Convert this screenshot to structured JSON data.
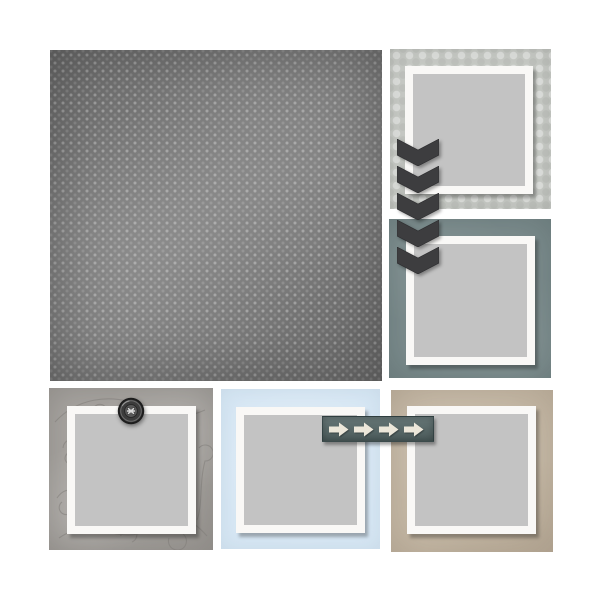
{
  "page": {
    "name": "Digital scrapbook quick-page layout with five photo frames",
    "background": "#ffffff"
  },
  "palette": {
    "page_bg": "#ffffff",
    "dot_paper": "#7e7e7e",
    "sage_paper": "#c7cac5",
    "slate_paper": "#7e8e8f",
    "swirl_paper": "#a8a5a1",
    "swirl_line": "#807d79",
    "blue_paper": "#d7e7f4",
    "tan_paper": "#c8bca9",
    "frame_white": "#f9f8f6",
    "photo_gray": "#c3c3c3",
    "chevron": "#3d3d3f",
    "ribbon": "#566868",
    "ribbon_arrow": "#ece7da",
    "button_dark": "#2a2a2a"
  },
  "papers": [
    {
      "label": "Charcoal pin-dot paper",
      "pattern": "light dot grid on mottled charcoal",
      "color": "#7e7e7e"
    },
    {
      "label": "Sage gray circle paper",
      "pattern": "tone-on-tone polka circles",
      "color": "#c7cac5"
    },
    {
      "label": "Slate blue-gray paper",
      "pattern": "subtle mottled texture",
      "color": "#7e8e8f"
    },
    {
      "label": "Gray doodle swirl paper",
      "pattern": "thin doodled loops and swirls",
      "color": "#a8a5a1"
    },
    {
      "label": "Powder blue paper",
      "pattern": "solid",
      "color": "#d7e7f4"
    },
    {
      "label": "Tan kraft paper",
      "pattern": "solid mottled",
      "color": "#c8bca9"
    }
  ],
  "photo_slots": [
    {
      "label": "Photo slot 1 - top right"
    },
    {
      "label": "Photo slot 2 - middle right"
    },
    {
      "label": "Photo slot 3 - bottom left"
    },
    {
      "label": "Photo slot 4 - bottom center"
    },
    {
      "label": "Photo slot 5 - bottom right"
    }
  ],
  "embellishments": {
    "chevron_stack": {
      "label": "Stacked chevron arrows pointing down",
      "count": 5,
      "direction": "down",
      "color": "#3d3d3f"
    },
    "arrow_ribbon": {
      "label": "Slate tape ribbon with cream arrows pointing right",
      "arrow_count": 4,
      "direction": "right",
      "ribbon_color": "#566868",
      "arrow_color": "#ece7da"
    },
    "button": {
      "label": "Dark stitched button",
      "color": "#2a2a2a",
      "thread_color": "#d9d9d9"
    }
  }
}
